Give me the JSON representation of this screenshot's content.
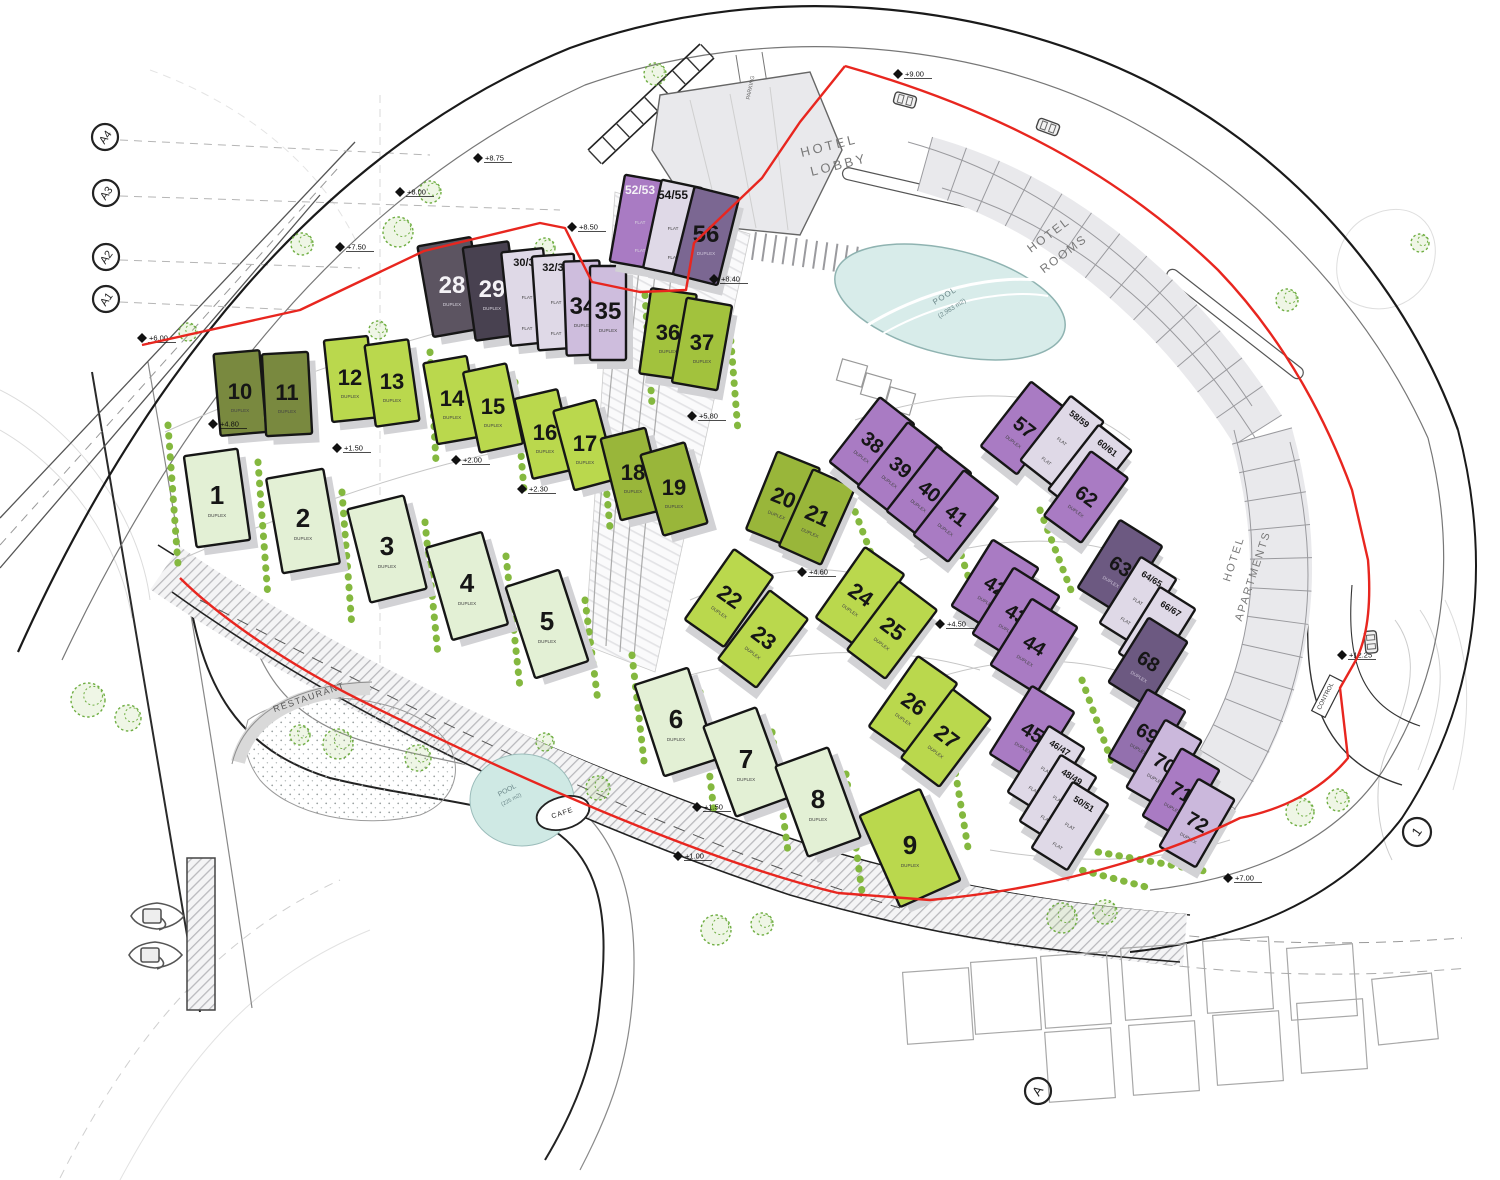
{
  "plan": {
    "legend": "buildings array fields: [label, cx, cy, w, h, rotationDeg, fillKey, fontSize, textRotatesWithBuilding(0/1), subLabel, subLabelAtTop(0/1), whiteText(0/1)]",
    "colors": {
      "pale": "#e3f0d5",
      "lime": "#bad84d",
      "lime2": "#a2c23d",
      "olive": "#79893f",
      "olive2": "#99b63a",
      "dgray": "#5c5461",
      "dgray2": "#484150",
      "lav": "#dfd9e7",
      "lpurp": "#cebddd",
      "mpurp": "#a97bc3",
      "mpurp2": "#9370ae",
      "lpurp2": "#cbb8dc",
      "dpurp": "#6c5981",
      "dpurp2": "#7b6792",
      "outline": "#161616",
      "boundary": "#e8261f",
      "hedge": "#84b83f",
      "tree": "#6fae42",
      "water": "#d8ecea",
      "band": "#e9e9ec"
    },
    "buildings": [
      [
        "1",
        217,
        498,
        54,
        92,
        -8,
        "pale",
        26,
        0,
        "DUPLEX",
        0,
        0
      ],
      [
        "2",
        303,
        521,
        58,
        96,
        -10,
        "pale",
        26,
        0,
        "DUPLEX",
        0,
        0
      ],
      [
        "3",
        387,
        549,
        58,
        96,
        -14,
        "pale",
        26,
        0,
        "DUPLEX",
        0,
        0
      ],
      [
        "4",
        467,
        586,
        58,
        96,
        -16,
        "pale",
        26,
        0,
        "DUPLEX",
        0,
        0
      ],
      [
        "5",
        547,
        624,
        56,
        96,
        -18,
        "pale",
        26,
        0,
        "DUPLEX",
        0,
        0
      ],
      [
        "6",
        676,
        722,
        56,
        96,
        -18,
        "pale",
        26,
        0,
        "DUPLEX",
        0,
        0
      ],
      [
        "7",
        746,
        762,
        56,
        96,
        -20,
        "pale",
        26,
        0,
        "DUPLEX",
        0,
        0
      ],
      [
        "8",
        818,
        802,
        56,
        96,
        -20,
        "pale",
        26,
        0,
        "DUPLEX",
        0,
        0
      ],
      [
        "9",
        910,
        848,
        66,
        100,
        -24,
        "lime",
        26,
        0,
        "DUPLEX",
        0,
        0
      ],
      [
        "10",
        240,
        393,
        46,
        82,
        -5,
        "olive",
        22,
        0,
        "DUPLEX",
        0,
        0
      ],
      [
        "11",
        287,
        394,
        46,
        82,
        -3,
        "olive",
        22,
        0,
        "DUPLEX",
        0,
        0
      ],
      [
        "12",
        350,
        379,
        44,
        82,
        -6,
        "lime",
        22,
        0,
        "DUPLEX",
        0,
        0
      ],
      [
        "13",
        392,
        383,
        44,
        82,
        -8,
        "lime",
        22,
        0,
        "DUPLEX",
        0,
        0
      ],
      [
        "14",
        452,
        400,
        44,
        82,
        -10,
        "lime",
        22,
        0,
        "DUPLEX",
        0,
        0
      ],
      [
        "15",
        493,
        408,
        44,
        82,
        -12,
        "lime",
        22,
        0,
        "DUPLEX",
        0,
        0
      ],
      [
        "16",
        545,
        434,
        44,
        82,
        -13,
        "lime",
        22,
        0,
        "DUPLEX",
        0,
        0
      ],
      [
        "17",
        585,
        445,
        44,
        82,
        -15,
        "lime",
        22,
        0,
        "DUPLEX",
        0,
        0
      ],
      [
        "18",
        633,
        474,
        46,
        84,
        -14,
        "olive2",
        22,
        0,
        "DUPLEX",
        0,
        0
      ],
      [
        "19",
        674,
        489,
        46,
        84,
        -16,
        "olive2",
        22,
        0,
        "DUPLEX",
        0,
        0
      ],
      [
        "20",
        783,
        499,
        46,
        84,
        22,
        "olive2",
        22,
        1,
        "DUPLEX",
        0,
        0
      ],
      [
        "21",
        817,
        517,
        46,
        84,
        24,
        "olive2",
        22,
        1,
        "DUPLEX",
        0,
        0
      ],
      [
        "22",
        729,
        598,
        48,
        86,
        35,
        "lime",
        22,
        1,
        "DUPLEX",
        0,
        0
      ],
      [
        "23",
        763,
        639,
        48,
        86,
        37,
        "lime",
        22,
        1,
        "DUPLEX",
        0,
        0
      ],
      [
        "24",
        860,
        596,
        48,
        86,
        35,
        "lime",
        22,
        1,
        "DUPLEX",
        0,
        0
      ],
      [
        "25",
        892,
        630,
        48,
        86,
        37,
        "lime",
        22,
        1,
        "DUPLEX",
        0,
        0
      ],
      [
        "26",
        913,
        705,
        48,
        86,
        35,
        "lime",
        22,
        1,
        "DUPLEX",
        0,
        0
      ],
      [
        "27",
        946,
        738,
        48,
        86,
        37,
        "lime",
        22,
        1,
        "DUPLEX",
        0,
        0
      ],
      [
        "28",
        452,
        287,
        54,
        92,
        -10,
        "dgray",
        24,
        0,
        "DUPLEX",
        0,
        1
      ],
      [
        "29",
        492,
        291,
        46,
        94,
        -8,
        "dgray2",
        24,
        0,
        "DUPLEX",
        0,
        1
      ],
      [
        "30/31",
        527,
        297,
        42,
        94,
        -6,
        "lav",
        11,
        0,
        "FLAT",
        1,
        0
      ],
      [
        "32/33",
        556,
        302,
        42,
        94,
        -4,
        "lav",
        11,
        0,
        "FLAT",
        1,
        0
      ],
      [
        "34",
        583,
        308,
        36,
        94,
        -2,
        "lpurp",
        24,
        0,
        "DUPLEX",
        0,
        0
      ],
      [
        "35",
        608,
        313,
        36,
        94,
        0,
        "lpurp",
        24,
        0,
        "DUPLEX",
        0,
        0
      ],
      [
        "36",
        668,
        334,
        46,
        86,
        8,
        "lime2",
        22,
        0,
        "DUPLEX",
        0,
        0
      ],
      [
        "37",
        702,
        344,
        46,
        86,
        10,
        "lime2",
        22,
        0,
        "DUPLEX",
        0,
        0
      ],
      [
        "38",
        872,
        443,
        44,
        82,
        38,
        "mpurp",
        20,
        1,
        "DUPLEX",
        0,
        0
      ],
      [
        "39",
        900,
        468,
        44,
        82,
        38,
        "mpurp",
        20,
        1,
        "DUPLEX",
        0,
        0
      ],
      [
        "40",
        929,
        492,
        44,
        82,
        38,
        "mpurp",
        20,
        1,
        "DUPLEX",
        0,
        0
      ],
      [
        "41",
        956,
        516,
        44,
        82,
        38,
        "mpurp",
        20,
        1,
        "DUPLEX",
        0,
        0
      ],
      [
        "42",
        995,
        587,
        54,
        78,
        32,
        "mpurp",
        20,
        1,
        "DUPLEX",
        0,
        0
      ],
      [
        "43",
        1016,
        615,
        54,
        78,
        32,
        "mpurp",
        20,
        1,
        "DUPLEX",
        0,
        0
      ],
      [
        "44",
        1034,
        646,
        54,
        78,
        32,
        "mpurp",
        20,
        1,
        "DUPLEX",
        0,
        0
      ],
      [
        "45",
        1032,
        733,
        50,
        80,
        32,
        "mpurp",
        20,
        1,
        "DUPLEX",
        0,
        0
      ],
      [
        "46/47",
        1046,
        770,
        42,
        78,
        32,
        "lav",
        9,
        1,
        "FLAT",
        1,
        0
      ],
      [
        "48/49",
        1058,
        799,
        42,
        78,
        32,
        "lav",
        9,
        1,
        "FLAT",
        1,
        0
      ],
      [
        "50/51",
        1070,
        826,
        42,
        78,
        32,
        "lav",
        9,
        1,
        "FLAT",
        1,
        0
      ],
      [
        "52/53",
        640,
        222,
        46,
        88,
        10,
        "mpurp",
        12,
        0,
        "FLAT",
        1,
        1
      ],
      [
        "54/55",
        673,
        228,
        42,
        90,
        12,
        "lav",
        12,
        0,
        "FLAT",
        1,
        0
      ],
      [
        "56",
        706,
        236,
        46,
        90,
        14,
        "dpurp2",
        24,
        0,
        "DUPLEX",
        0,
        0
      ],
      [
        "57",
        1024,
        428,
        46,
        82,
        38,
        "mpurp",
        20,
        1,
        "DUPLEX",
        0,
        0
      ],
      [
        "58/59",
        1062,
        441,
        42,
        82,
        38,
        "lav",
        9,
        1,
        "FLAT",
        1,
        0
      ],
      [
        "60/61",
        1090,
        470,
        42,
        82,
        38,
        "lav",
        9,
        1,
        "FLAT",
        1,
        0
      ],
      [
        "62",
        1086,
        497,
        46,
        80,
        36,
        "mpurp",
        20,
        1,
        "DUPLEX",
        0,
        0
      ],
      [
        "63",
        1120,
        567,
        50,
        80,
        32,
        "dpurp",
        20,
        1,
        "DUPLEX",
        0,
        0
      ],
      [
        "64/65",
        1138,
        601,
        42,
        78,
        32,
        "lav",
        9,
        1,
        "FLAT",
        1,
        0
      ],
      [
        "66/67",
        1157,
        631,
        42,
        78,
        32,
        "lav",
        9,
        1,
        "FLAT",
        1,
        0
      ],
      [
        "68",
        1148,
        662,
        46,
        76,
        32,
        "dpurp",
        20,
        1,
        "DUPLEX",
        0,
        0
      ],
      [
        "69",
        1147,
        734,
        44,
        78,
        30,
        "mpurp2",
        20,
        1,
        "DUPLEX",
        0,
        0
      ],
      [
        "70",
        1164,
        764,
        42,
        78,
        30,
        "lpurp2",
        20,
        1,
        "DUPLEX",
        0,
        0
      ],
      [
        "71",
        1181,
        793,
        44,
        78,
        30,
        "mpurp",
        20,
        1,
        "DUPLEX",
        0,
        0
      ],
      [
        "72",
        1197,
        823,
        42,
        78,
        30,
        "lpurp2",
        20,
        1,
        "DUPLEX",
        0,
        0
      ]
    ],
    "labels": [
      {
        "t": "HOTEL",
        "x": 830,
        "y": 150,
        "r": -14,
        "s": 13,
        "c": "#787878",
        "ls": 3
      },
      {
        "t": "LOBBY",
        "x": 840,
        "y": 169,
        "r": -14,
        "s": 13,
        "c": "#787878",
        "ls": 3
      },
      {
        "t": "HOTEL",
        "x": 1051,
        "y": 238,
        "r": -37,
        "s": 12,
        "c": "#787878",
        "ls": 2
      },
      {
        "t": "ROOMS",
        "x": 1066,
        "y": 257,
        "r": -37,
        "s": 12,
        "c": "#787878",
        "ls": 2
      },
      {
        "t": "HOTEL",
        "x": 1237,
        "y": 560,
        "r": -72,
        "s": 11,
        "c": "#787878",
        "ls": 2
      },
      {
        "t": "APARTMENTS",
        "x": 1256,
        "y": 577,
        "r": -72,
        "s": 11,
        "c": "#787878",
        "ls": 2
      },
      {
        "t": "POOL",
        "x": 946,
        "y": 298,
        "r": -32,
        "s": 8,
        "c": "#6b8789",
        "ls": 1
      },
      {
        "t": "(2,983 m2)",
        "x": 953,
        "y": 310,
        "r": -32,
        "s": 6.5,
        "c": "#6b8789",
        "ls": 0
      },
      {
        "t": "POOL",
        "x": 508,
        "y": 792,
        "r": -28,
        "s": 7,
        "c": "#6b8789",
        "ls": 0
      },
      {
        "t": "(225 m2)",
        "x": 512,
        "y": 801,
        "r": -28,
        "s": 5.5,
        "c": "#6b8789",
        "ls": 0
      },
      {
        "t": "CAFE",
        "x": 563,
        "y": 815,
        "r": -18,
        "s": 7,
        "c": "#222222",
        "ls": 1
      },
      {
        "t": "RESTAURANT",
        "x": 310,
        "y": 700,
        "r": -19,
        "s": 9,
        "c": "#555555",
        "ls": 1.5
      },
      {
        "t": "CONTROL",
        "x": 1327,
        "y": 697,
        "r": -63,
        "s": 6,
        "c": "#333333",
        "ls": 0
      },
      {
        "t": "PARKING",
        "x": 752,
        "y": 88,
        "r": -78,
        "s": 5.5,
        "c": "#666666",
        "ls": 0
      }
    ],
    "elevation_markers": [
      {
        "v": "+9.00",
        "x": 898,
        "y": 74
      },
      {
        "v": "+8.75",
        "x": 478,
        "y": 158
      },
      {
        "v": "+8.00",
        "x": 400,
        "y": 192
      },
      {
        "v": "+7.50",
        "x": 340,
        "y": 247
      },
      {
        "v": "+8.50",
        "x": 572,
        "y": 227
      },
      {
        "v": "+8.40",
        "x": 714,
        "y": 279
      },
      {
        "v": "+6.00",
        "x": 142,
        "y": 338
      },
      {
        "v": "+4.80",
        "x": 213,
        "y": 424
      },
      {
        "v": "+1.50",
        "x": 337,
        "y": 448
      },
      {
        "v": "+2.00",
        "x": 456,
        "y": 460
      },
      {
        "v": "+2.30",
        "x": 522,
        "y": 489
      },
      {
        "v": "+5.80",
        "x": 692,
        "y": 416
      },
      {
        "v": "+4.60",
        "x": 802,
        "y": 572
      },
      {
        "v": "+4.50",
        "x": 940,
        "y": 624
      },
      {
        "v": "+1.50",
        "x": 697,
        "y": 807
      },
      {
        "v": "+1.00",
        "x": 678,
        "y": 856
      },
      {
        "v": "+12.25",
        "x": 1342,
        "y": 655
      },
      {
        "v": "+7.00",
        "x": 1228,
        "y": 878
      }
    ],
    "grid_circles": [
      {
        "label": "A4",
        "x": 105,
        "y": 137
      },
      {
        "label": "A3",
        "x": 106,
        "y": 193
      },
      {
        "label": "A2",
        "x": 106,
        "y": 257
      },
      {
        "label": "A1",
        "x": 106,
        "y": 299
      }
    ],
    "ref_circles": [
      {
        "label": "1",
        "x": 1417,
        "y": 832,
        "r": 14
      },
      {
        "label": "A",
        "x": 1038,
        "y": 1091,
        "r": 13
      }
    ],
    "hedges": [
      [
        168,
        425,
        178,
        565
      ],
      [
        258,
        462,
        268,
        598
      ],
      [
        342,
        492,
        352,
        628
      ],
      [
        425,
        522,
        438,
        655
      ],
      [
        506,
        556,
        520,
        688
      ],
      [
        585,
        600,
        598,
        702
      ],
      [
        632,
        655,
        645,
        770
      ],
      [
        700,
        692,
        714,
        812
      ],
      [
        772,
        732,
        788,
        852
      ],
      [
        846,
        774,
        862,
        892
      ],
      [
        430,
        352,
        436,
        462
      ],
      [
        515,
        382,
        524,
        490
      ],
      [
        600,
        420,
        610,
        528
      ],
      [
        645,
        295,
        652,
        405
      ],
      [
        730,
        330,
        738,
        432
      ],
      [
        840,
        472,
        872,
        556
      ],
      [
        958,
        545,
        988,
        638
      ],
      [
        1040,
        510,
        1074,
        598
      ],
      [
        1082,
        680,
        1114,
        768
      ],
      [
        1098,
        852,
        1210,
        872
      ],
      [
        952,
        752,
        968,
        848
      ],
      [
        1062,
        865,
        1150,
        888
      ]
    ],
    "trees": [
      [
        398,
        232,
        15
      ],
      [
        430,
        192,
        11
      ],
      [
        302,
        244,
        11
      ],
      [
        188,
        332,
        9
      ],
      [
        88,
        700,
        17
      ],
      [
        128,
        718,
        13
      ],
      [
        338,
        744,
        15
      ],
      [
        300,
        735,
        10
      ],
      [
        418,
        758,
        13
      ],
      [
        598,
        788,
        12
      ],
      [
        545,
        742,
        9
      ],
      [
        716,
        930,
        15
      ],
      [
        762,
        924,
        11
      ],
      [
        1062,
        918,
        15
      ],
      [
        1105,
        912,
        12
      ],
      [
        1300,
        812,
        14
      ],
      [
        1338,
        800,
        11
      ],
      [
        655,
        74,
        11
      ],
      [
        545,
        248,
        10
      ],
      [
        378,
        330,
        9
      ],
      [
        1287,
        300,
        11
      ],
      [
        1420,
        243,
        9
      ]
    ],
    "cars": [
      {
        "x": 905,
        "y": 100,
        "r": 15
      },
      {
        "x": 1048,
        "y": 127,
        "r": 20
      },
      {
        "x": 1371,
        "y": 642,
        "r": 85
      }
    ],
    "boats": {
      "count": 2
    },
    "sub_label_flat": "FLAT",
    "sub_label_duplex": "DUPLEX"
  }
}
